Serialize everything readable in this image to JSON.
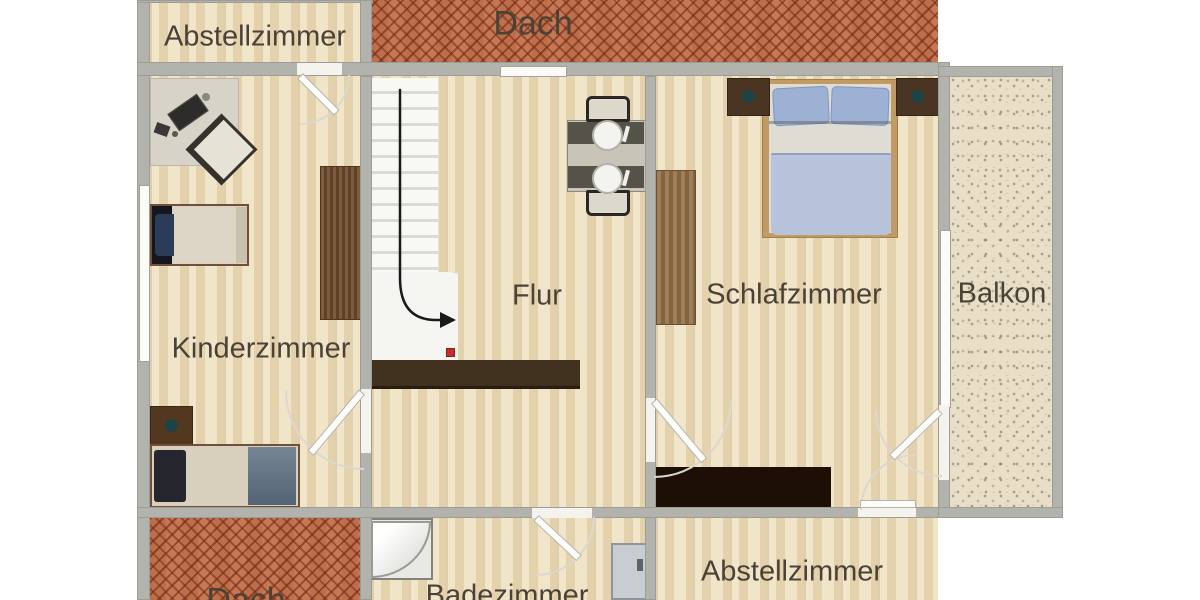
{
  "meta": {
    "view_title": "Obergeschoss Grundriss"
  },
  "rooms": {
    "abstell_top": {
      "label": "Abstellzimmer"
    },
    "dach_top": {
      "label": "Dach"
    },
    "kinderzimmer": {
      "label": "Kinderzimmer"
    },
    "flur": {
      "label": "Flur"
    },
    "schlafzimmer": {
      "label": "Schlafzimmer"
    },
    "balkon": {
      "label": "Balkon"
    },
    "dach_bottom": {
      "label": "Dach"
    },
    "badezimmer": {
      "label": "Badezimmer"
    },
    "abstell_bottom": {
      "label": "Abstellzimmer"
    }
  },
  "colors": {
    "wall": "#b2b3ad",
    "wood_floor": "#eadcba",
    "roof_brick": "#b4603c",
    "balcony_floor": "#e9dfc8",
    "label_text": "#4b4237",
    "marker_red": "#c53026",
    "bed_blanket_blue": "#b6c3da",
    "dark_sideboard": "#1d0f06"
  }
}
